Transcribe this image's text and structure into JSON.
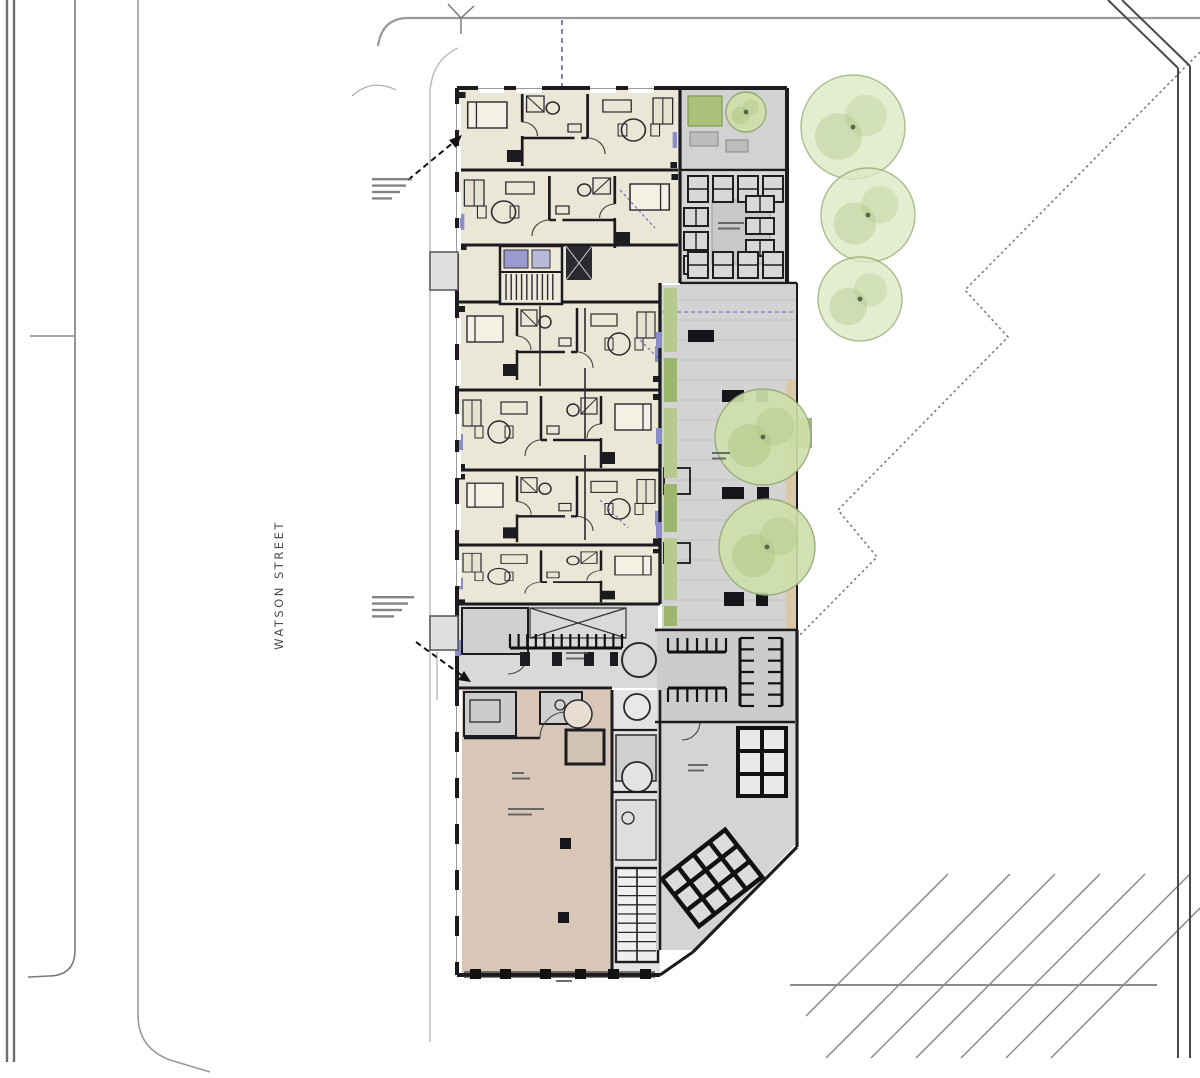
{
  "street": {
    "label": "WATSON STREET"
  },
  "colors": {
    "wall": "#1b1b20",
    "apartmentFill": "#ebe7d6",
    "retailFill": "#d8c7b7",
    "pavingFill": "#d3d3d3",
    "bikeAreaFill": "#cccccc",
    "treeFill": "#cfdfab",
    "treeStroke": "#93a873",
    "treePatch": "#a9c07c",
    "siteTreeFill": "#dde8c4",
    "planterGreen": "#a9c178",
    "deckTan": "#d9c9a8",
    "accentPurple": "#8c8cc8",
    "accentBlue": "#5a5ab0",
    "siteLine": "#8a8a8a",
    "lightLine": "#bbbbbb"
  },
  "site_trees": [
    {
      "cx": 853,
      "cy": 127,
      "r": 52
    },
    {
      "cx": 868,
      "cy": 215,
      "r": 47
    },
    {
      "cx": 860,
      "cy": 299,
      "r": 42
    }
  ],
  "courtyard_trees": [
    {
      "cx": 763,
      "cy": 437,
      "r": 48
    },
    {
      "cx": 767,
      "cy": 547,
      "r": 48
    }
  ],
  "terrace_tree": {
    "cx": 746,
    "cy": 112,
    "r": 20
  },
  "benches": [
    [
      688,
      330,
      26,
      12
    ],
    [
      722,
      390,
      22,
      12
    ],
    [
      756,
      390,
      12,
      12
    ],
    [
      722,
      487,
      22,
      12
    ],
    [
      757,
      487,
      12,
      12
    ],
    [
      724,
      592,
      20,
      14
    ],
    [
      756,
      592,
      12,
      14
    ]
  ],
  "green_strip": {
    "x": 664,
    "w": 13,
    "segments": [
      [
        288,
        64
      ],
      [
        358,
        44
      ],
      [
        408,
        70
      ],
      [
        484,
        48
      ],
      [
        538,
        62
      ],
      [
        606,
        20
      ]
    ]
  },
  "bike_combs": [
    {
      "x": 510,
      "y": 648,
      "len": 112,
      "teeth": 14,
      "dir": "up"
    },
    {
      "x": 668,
      "y": 652,
      "len": 58,
      "teeth": 7,
      "dir": "up"
    },
    {
      "x": 668,
      "y": 688,
      "len": 58,
      "teeth": 7,
      "dir": "down"
    },
    {
      "x": 740,
      "y": 638,
      "len": 68,
      "teeth": 7,
      "dir": "right"
    },
    {
      "x": 782,
      "y": 638,
      "len": 68,
      "teeth": 7,
      "dir": "left"
    }
  ],
  "bike_stalls": [
    {
      "x": 688,
      "y": 176,
      "w": 20,
      "h": 26,
      "count": 4,
      "dx": 25,
      "dy": 0
    },
    {
      "x": 684,
      "y": 208,
      "w": 24,
      "h": 18,
      "count": 3,
      "dx": 0,
      "dy": 24
    },
    {
      "x": 746,
      "y": 196,
      "w": 28,
      "h": 16,
      "count": 3,
      "dx": 0,
      "dy": 22
    },
    {
      "x": 688,
      "y": 252,
      "w": 20,
      "h": 26,
      "count": 4,
      "dx": 25,
      "dy": 0
    }
  ],
  "annotation_blocks": [
    {
      "x": 372,
      "y": 178,
      "widths": [
        40,
        34,
        28,
        20
      ]
    },
    {
      "x": 372,
      "y": 596,
      "widths": [
        42,
        36,
        30,
        22
      ]
    }
  ],
  "micro_labels": [
    {
      "x": 718,
      "y": 222,
      "widths": [
        26,
        22
      ]
    },
    {
      "x": 566,
      "y": 652,
      "widths": [
        22,
        18
      ]
    },
    {
      "x": 688,
      "y": 764,
      "widths": [
        20,
        16
      ]
    },
    {
      "x": 512,
      "y": 772,
      "widths": [
        12,
        18
      ]
    },
    {
      "x": 508,
      "y": 808,
      "widths": [
        36,
        24
      ]
    },
    {
      "x": 556,
      "y": 980,
      "widths": [
        16
      ]
    },
    {
      "x": 712,
      "y": 452,
      "widths": [
        18,
        14
      ]
    }
  ],
  "purple_headers": [
    [
      656,
      332,
      6,
      16
    ],
    [
      656,
      428,
      6,
      16
    ],
    [
      656,
      522,
      6,
      16
    ],
    [
      455,
      640,
      6,
      16
    ]
  ],
  "windows": {
    "left_upper": [
      104,
      146,
      192,
      228,
      318,
      360,
      414,
      452,
      504,
      560
    ],
    "left_lower": [
      706,
      752,
      798,
      844,
      890,
      936
    ],
    "top": [
      478,
      516,
      590,
      628
    ]
  },
  "storefront_mullions": [
    470,
    500,
    540,
    575,
    608,
    640
  ]
}
